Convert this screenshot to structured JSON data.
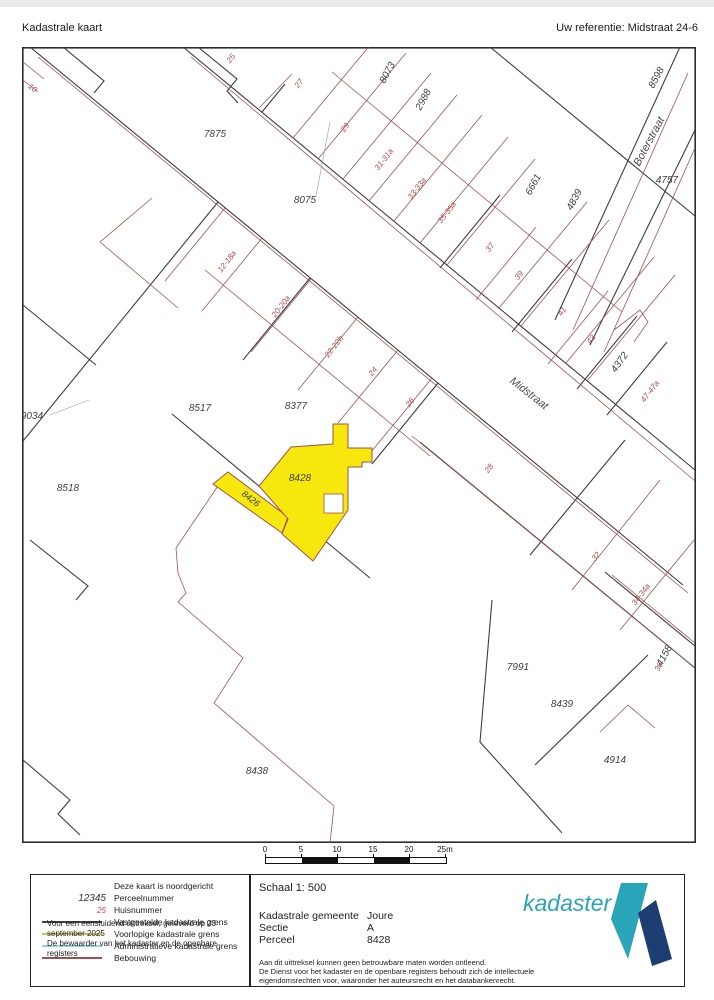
{
  "header": {
    "title": "Kadastrale kaart",
    "reference": "Uw referentie: Midstraat 24-6"
  },
  "map": {
    "highlight_color": "#f6e70c",
    "street_labels": [
      {
        "t": "Midstraat",
        "x": 527,
        "y": 396,
        "r": 38
      },
      {
        "t": "Boterstraat",
        "x": 652,
        "y": 143,
        "r": -62
      }
    ],
    "parcel_labels": [
      {
        "t": "7875",
        "x": 215,
        "y": 137,
        "r": 0
      },
      {
        "t": "8075",
        "x": 305,
        "y": 203,
        "r": 0
      },
      {
        "t": "8073",
        "x": 390,
        "y": 74,
        "r": -62
      },
      {
        "t": "2988",
        "x": 426,
        "y": 101,
        "r": -62
      },
      {
        "t": "6661",
        "x": 536,
        "y": 186,
        "r": -62
      },
      {
        "t": "4839",
        "x": 577,
        "y": 201,
        "r": -62
      },
      {
        "t": "8598",
        "x": 659,
        "y": 79,
        "r": -62
      },
      {
        "t": "4757",
        "x": 667,
        "y": 183,
        "r": 0
      },
      {
        "t": "4372",
        "x": 622,
        "y": 364,
        "r": -55
      },
      {
        "t": "8517",
        "x": 200,
        "y": 411,
        "r": 0
      },
      {
        "t": "8377",
        "x": 296,
        "y": 409,
        "r": 0
      },
      {
        "t": "8428",
        "x": 300,
        "y": 481,
        "r": 0
      },
      {
        "t": "8426",
        "x": 249,
        "y": 501,
        "r": 38,
        "s": 9
      },
      {
        "t": "9034",
        "x": 32,
        "y": 419,
        "r": 0
      },
      {
        "t": "8518",
        "x": 68,
        "y": 491,
        "r": 0
      },
      {
        "t": "8438",
        "x": 257,
        "y": 774,
        "r": 0
      },
      {
        "t": "7991",
        "x": 518,
        "y": 670,
        "r": 0
      },
      {
        "t": "8439",
        "x": 562,
        "y": 707,
        "r": 0
      },
      {
        "t": "4914",
        "x": 615,
        "y": 763,
        "r": 0
      },
      {
        "t": "4158",
        "x": 667,
        "y": 657,
        "r": -62
      }
    ],
    "house_labels": [
      {
        "t": "10",
        "x": 31,
        "y": 90,
        "r": 38
      },
      {
        "t": "25",
        "x": 233,
        "y": 60,
        "r": -52
      },
      {
        "t": "27",
        "x": 301,
        "y": 85,
        "r": -52
      },
      {
        "t": "29",
        "x": 347,
        "y": 129,
        "r": -52
      },
      {
        "t": "31-31a",
        "x": 386,
        "y": 161,
        "r": -52
      },
      {
        "t": "33-33a",
        "x": 419,
        "y": 190,
        "r": -52
      },
      {
        "t": "35-35a",
        "x": 449,
        "y": 214,
        "r": -52
      },
      {
        "t": "37",
        "x": 492,
        "y": 249,
        "r": -52
      },
      {
        "t": "39",
        "x": 521,
        "y": 277,
        "r": -52
      },
      {
        "t": "41",
        "x": 564,
        "y": 313,
        "r": -52
      },
      {
        "t": "43",
        "x": 593,
        "y": 341,
        "r": -52
      },
      {
        "t": "47-47a",
        "x": 652,
        "y": 393,
        "r": -52
      },
      {
        "t": "12-18a",
        "x": 229,
        "y": 263,
        "r": -52
      },
      {
        "t": "20-20a",
        "x": 283,
        "y": 308,
        "r": -52
      },
      {
        "t": "22-22b",
        "x": 336,
        "y": 348,
        "r": -52
      },
      {
        "t": "24",
        "x": 375,
        "y": 373,
        "r": -52
      },
      {
        "t": "26",
        "x": 412,
        "y": 404,
        "r": -52
      },
      {
        "t": "28",
        "x": 491,
        "y": 470,
        "r": -52
      },
      {
        "t": "32",
        "x": 598,
        "y": 558,
        "r": -52
      },
      {
        "t": "34-34a",
        "x": 643,
        "y": 596,
        "r": -52
      },
      {
        "t": "36",
        "x": 661,
        "y": 668,
        "r": -62
      }
    ]
  },
  "scalebar": {
    "ticks": [
      "0",
      "5",
      "10",
      "15",
      "20",
      "25m"
    ]
  },
  "footer": {
    "north_note": "Deze kaart is noordgericht",
    "legend": [
      {
        "type": "text-parcel",
        "sym": "12345",
        "label": "Perceelnummer"
      },
      {
        "type": "text-house",
        "sym": "25",
        "label": "Huisnummer"
      },
      {
        "type": "line",
        "color": "#404040",
        "label": "Vastgestelde kadastrale grens"
      },
      {
        "type": "line",
        "color": "#ccbd55",
        "label": "Voorlopige kadastrale grens"
      },
      {
        "type": "line",
        "color": "#8fd9e6",
        "label": "Administratieve kadastrale grens"
      },
      {
        "type": "line",
        "color": "#a04e4e",
        "label": "Bebouwing"
      }
    ],
    "issue_line1": "Voor een eensluidend uittreksel, geleverd op 23 september 2025",
    "issue_line2": "De bewaarder van het kadaster en de openbare registers",
    "scale_label": "Schaal 1: 500",
    "fields": [
      {
        "label": "Kadastrale gemeente",
        "value": "Joure"
      },
      {
        "label": "Sectie",
        "value": "A"
      },
      {
        "label": "Perceel",
        "value": "8428"
      }
    ],
    "disclaimer": [
      "Aan dit uittreksel kunnen geen betrouwbare maten worden ontleend.",
      "De Dienst voor het kadaster en de openbare registers behoudt zich de intellectuele",
      "eigendomsrechten voor, waaronder het auteursrecht en het databankenrecht."
    ],
    "logo_text": "kadaster"
  }
}
